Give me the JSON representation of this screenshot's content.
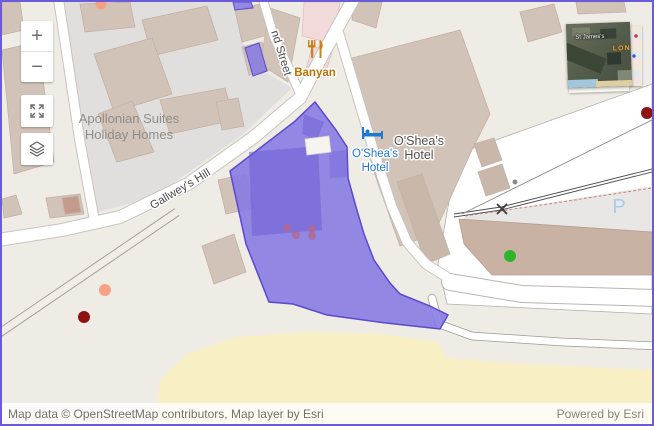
{
  "window": {
    "border_color": "#6a5cd8"
  },
  "attribution": {
    "left": "Map data © OpenStreetMap contributors, Map layer by Esri",
    "right": "Powered by Esri"
  },
  "controls": {
    "zoom_in": "+",
    "zoom_out": "−"
  },
  "labels": {
    "apollonian": {
      "line1": "Apollonian Suites",
      "line2": "Holiday Homes"
    },
    "gallweys_hill": "Gallwey's Hill",
    "street": "nd Street",
    "banyan": "Banyan",
    "oshea_poi": {
      "line1": "O'Shea's",
      "line2": "Hotel"
    },
    "oshea_building": {
      "line1": "O'Shea's",
      "line2": "Hotel"
    },
    "parking": "P"
  },
  "inset": {
    "place1": "St James's",
    "place2": "LON"
  },
  "colors": {
    "selection_fill": "#8579e2",
    "selection_stroke": "#5b49cf",
    "selection_inner": "#6e5fd6",
    "dot_dark_red": "#8e1212",
    "dot_salmon": "#f4a184",
    "dot_green": "#2fb42f",
    "dot_pink": "#b2688f",
    "poi_blue": "#1e78d2",
    "poi_orange": "#c8821c",
    "parking_blue": "#abcdec",
    "street_label": "#4c4c4c",
    "area_label": "#8f8c88",
    "building_label": "#56504b"
  }
}
